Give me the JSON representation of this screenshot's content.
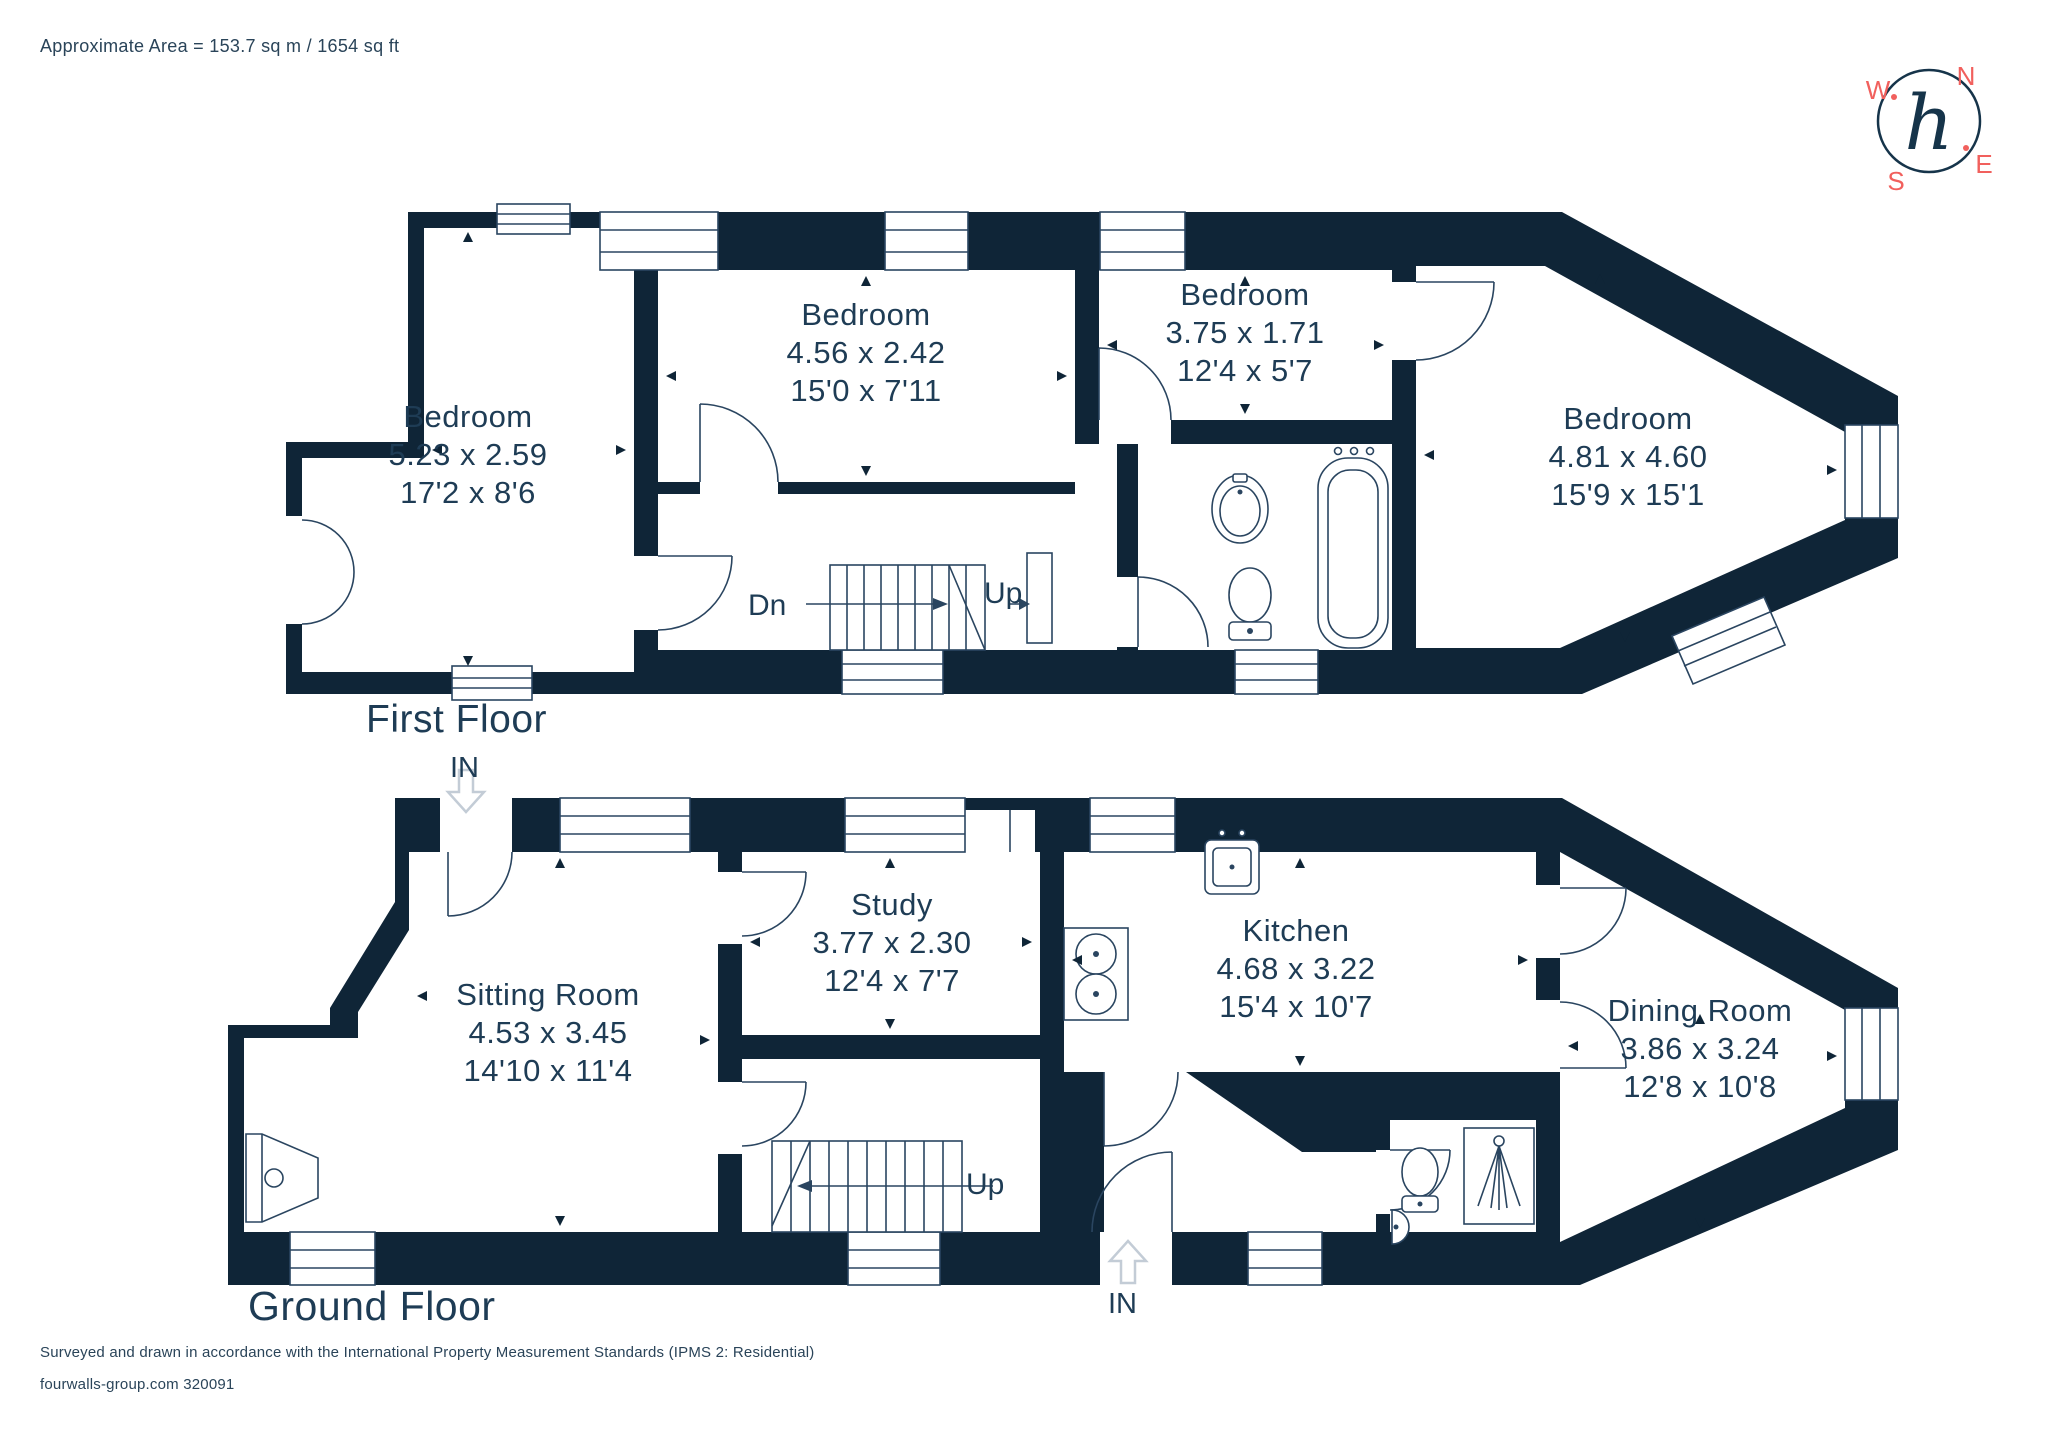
{
  "header": {
    "approx_area": "Approximate Area = 153.7 sq m / 1654 sq ft"
  },
  "compass": {
    "n": "N",
    "e": "E",
    "s": "S",
    "w": "W",
    "monogram": "h",
    "accent_color": "#f1605d"
  },
  "first_floor": {
    "title": "First Floor",
    "stair_down_label": "Dn",
    "stair_up_label": "Up",
    "rooms": [
      {
        "name": "Bedroom",
        "dim_m": "5.23 x 2.59",
        "dim_ft": "17'2 x 8'6"
      },
      {
        "name": "Bedroom",
        "dim_m": "4.56 x 2.42",
        "dim_ft": "15'0 x 7'11"
      },
      {
        "name": "Bedroom",
        "dim_m": "3.75 x 1.71",
        "dim_ft": "12'4 x 5'7"
      },
      {
        "name": "Bedroom",
        "dim_m": "4.81 x 4.60",
        "dim_ft": "15'9 x 15'1"
      }
    ]
  },
  "ground_floor": {
    "title": "Ground Floor",
    "stair_up_label": "Up",
    "entrance_top_label": "IN",
    "entrance_bottom_label": "IN",
    "rooms": [
      {
        "name": "Sitting Room",
        "dim_m": "4.53 x 3.45",
        "dim_ft": "14'10 x 11'4"
      },
      {
        "name": "Study",
        "dim_m": "3.77 x 2.30",
        "dim_ft": "12'4 x 7'7"
      },
      {
        "name": "Kitchen",
        "dim_m": "4.68 x 3.22",
        "dim_ft": "15'4 x 10'7"
      },
      {
        "name": "Dining Room",
        "dim_m": "3.86 x 3.24",
        "dim_ft": "12'8 x 10'8"
      }
    ]
  },
  "footer": {
    "line1": "Surveyed and drawn in accordance with the International Property Measurement Standards (IPMS 2: Residential)",
    "line2": "fourwalls-group.com 320091"
  },
  "colors": {
    "wall": "#0f2537",
    "text": "#1e3c55",
    "accent": "#f1605d"
  }
}
